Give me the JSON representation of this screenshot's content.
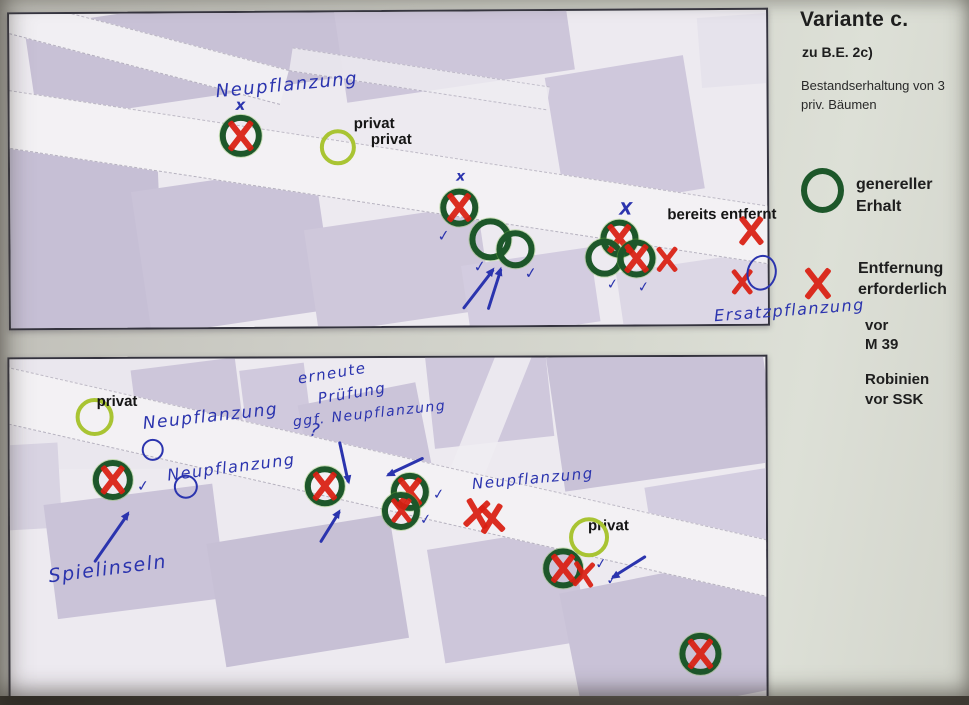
{
  "legend": {
    "title": "Variante c.",
    "subtitle": "zu B.E.  2c)",
    "note_line1": "Bestandserhaltung  von 3",
    "note_line2": "priv. Bäumen",
    "keep_line1": "genereller",
    "keep_line2": "Erhalt",
    "remove_line1": "Entfernung",
    "remove_line2": "erforderlich",
    "vor_line1": "vor",
    "vor_line2": "M  39",
    "rob_line1": "Robinien",
    "rob_line2": "vor SSK",
    "colors": {
      "keep_green": "#1d572a",
      "remove_red": "#da1f12",
      "private_green": "#a9c433",
      "ink_blue": "#2b34ae"
    }
  },
  "maps": {
    "top": {
      "items": [
        {
          "t": "hw",
          "text": "Neupflanzung",
          "x": 206,
          "y": 62,
          "s": 18,
          "rot": -5
        },
        {
          "t": "bx",
          "text": "x",
          "x": 226,
          "y": 85,
          "s": 15
        },
        {
          "t": "gcx",
          "x": 231,
          "y": 123,
          "r": 21,
          "xs": 32
        },
        {
          "t": "yc",
          "x": 328,
          "y": 135,
          "r": 18
        },
        {
          "t": "pt",
          "text": "privat",
          "x": 344,
          "y": 103
        },
        {
          "t": "pt",
          "text": "privat",
          "x": 361,
          "y": 119
        },
        {
          "t": "bx",
          "text": "x",
          "x": 446,
          "y": 158,
          "s": 14
        },
        {
          "t": "gcx",
          "x": 449,
          "y": 196,
          "r": 19,
          "xs": 30
        },
        {
          "t": "gc",
          "x": 480,
          "y": 228,
          "r": 21
        },
        {
          "t": "gc",
          "x": 505,
          "y": 238,
          "r": 19
        },
        {
          "t": "check",
          "x": 427,
          "y": 217,
          "s": 15
        },
        {
          "t": "check",
          "x": 463,
          "y": 248,
          "s": 15
        },
        {
          "t": "check",
          "x": 514,
          "y": 255,
          "s": 15
        },
        {
          "t": "arrow",
          "x": 452,
          "y": 296,
          "len": 50,
          "ang": -52
        },
        {
          "t": "arrow",
          "x": 477,
          "y": 297,
          "len": 43,
          "ang": -72
        },
        {
          "t": "bx",
          "text": "X",
          "x": 609,
          "y": 191,
          "s": 17
        },
        {
          "t": "gcx",
          "x": 609,
          "y": 228,
          "r": 19,
          "xs": 30
        },
        {
          "t": "gc",
          "x": 594,
          "y": 247,
          "r": 19
        },
        {
          "t": "gcx",
          "x": 626,
          "y": 248,
          "r": 19,
          "xs": 30
        },
        {
          "t": "rx",
          "x": 656,
          "y": 249,
          "s": 27
        },
        {
          "t": "pt",
          "text": "bereits entfernt",
          "x": 657,
          "y": 196
        },
        {
          "t": "rx",
          "x": 741,
          "y": 221,
          "s": 30
        },
        {
          "t": "rx",
          "x": 731,
          "y": 272,
          "s": 27
        },
        {
          "t": "bellipse",
          "x": 751,
          "y": 263,
          "rx": 15,
          "ry": 18,
          "rot": 14
        },
        {
          "t": "check",
          "x": 596,
          "y": 267,
          "s": 14
        },
        {
          "t": "check",
          "x": 627,
          "y": 270,
          "s": 14
        },
        {
          "t": "hw",
          "text": "Ersatzpflanzung",
          "x": 703,
          "y": 291,
          "s": 16,
          "rot": -4
        }
      ]
    },
    "bottom": {
      "items": [
        {
          "t": "yc",
          "x": 85,
          "y": 58,
          "r": 19
        },
        {
          "t": "pt",
          "text": "privat",
          "x": 87,
          "y": 34
        },
        {
          "t": "hw",
          "text": "Neupflanzung",
          "x": 133,
          "y": 48,
          "s": 17,
          "rot": -6
        },
        {
          "t": "bc",
          "x": 143,
          "y": 91,
          "r": 11
        },
        {
          "t": "hw",
          "text": "Neupflanzung",
          "x": 157,
          "y": 99,
          "s": 16,
          "rot": -7
        },
        {
          "t": "bc",
          "x": 176,
          "y": 128,
          "r": 12
        },
        {
          "t": "gcx",
          "x": 103,
          "y": 121,
          "r": 20,
          "xs": 30
        },
        {
          "t": "check",
          "x": 127,
          "y": 120,
          "s": 15
        },
        {
          "t": "arrow",
          "x": 84,
          "y": 202,
          "len": 60,
          "ang": -55
        },
        {
          "t": "hw",
          "text": "Spielinseln",
          "x": 38,
          "y": 199,
          "s": 19,
          "rot": -7
        },
        {
          "t": "hw",
          "text": "erneute",
          "x": 288,
          "y": 6,
          "s": 15,
          "rot": -9
        },
        {
          "t": "hw",
          "text": "Prüfung",
          "x": 308,
          "y": 26,
          "s": 15,
          "rot": -9
        },
        {
          "t": "hw",
          "text": "ggf. Neupflanzung",
          "x": 283,
          "y": 48,
          "s": 14,
          "rot": -6
        },
        {
          "t": "hw",
          "text": "?",
          "x": 300,
          "y": 62,
          "s": 18,
          "rot": 8
        },
        {
          "t": "arrow",
          "x": 330,
          "y": 82,
          "len": 42,
          "ang": 78
        },
        {
          "t": "arrow",
          "x": 414,
          "y": 99,
          "len": 40,
          "ang": 155
        },
        {
          "t": "gcx",
          "x": 315,
          "y": 128,
          "r": 20,
          "xs": 30
        },
        {
          "t": "gcx",
          "x": 400,
          "y": 134,
          "r": 19,
          "xs": 30
        },
        {
          "t": "gcx",
          "x": 391,
          "y": 153,
          "r": 19,
          "xs": 26
        },
        {
          "t": "check",
          "x": 423,
          "y": 130,
          "s": 14
        },
        {
          "t": "check",
          "x": 410,
          "y": 155,
          "s": 14
        },
        {
          "t": "arrow",
          "x": 310,
          "y": 183,
          "len": 37,
          "ang": -58
        },
        {
          "t": "hw",
          "text": "Neupflanzung",
          "x": 462,
          "y": 112,
          "s": 15,
          "rot": -5
        },
        {
          "t": "rx",
          "x": 467,
          "y": 156,
          "s": 30,
          "rot": 8
        },
        {
          "t": "rx",
          "x": 482,
          "y": 161,
          "s": 30,
          "rot": -6
        },
        {
          "t": "pt",
          "text": "privat",
          "x": 578,
          "y": 160
        },
        {
          "t": "yc",
          "x": 579,
          "y": 180,
          "r": 20
        },
        {
          "t": "gcx",
          "x": 553,
          "y": 211,
          "r": 20,
          "xs": 30
        },
        {
          "t": "rx",
          "x": 573,
          "y": 217,
          "s": 27,
          "rot": 5
        },
        {
          "t": "check",
          "x": 585,
          "y": 200,
          "s": 14
        },
        {
          "t": "check",
          "x": 596,
          "y": 216,
          "s": 14
        },
        {
          "t": "arrow",
          "x": 636,
          "y": 198,
          "len": 40,
          "ang": 148
        },
        {
          "t": "gcx",
          "x": 690,
          "y": 297,
          "r": 21,
          "xs": 32
        }
      ]
    }
  }
}
